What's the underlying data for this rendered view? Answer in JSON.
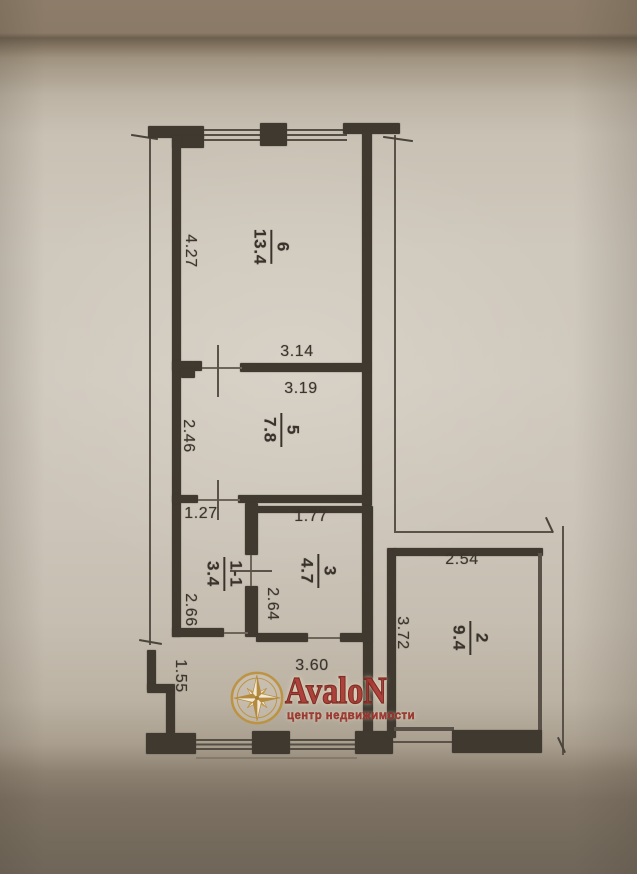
{
  "watermark": {
    "brand": "AvaloN",
    "tagline": "центр недвижимости",
    "brand_color": "#ad3c35",
    "gold_color": "#bd923f",
    "icon": "compass-rose-icon"
  },
  "rooms": [
    {
      "number": "6",
      "area": "13.4"
    },
    {
      "number": "5",
      "area": "7.8"
    },
    {
      "number": "1-1",
      "area": "3.4"
    },
    {
      "number": "3",
      "area": "4.7"
    },
    {
      "number": "2",
      "area": "9.4"
    }
  ],
  "dimensions": {
    "room6_height": "4.27",
    "room6_width": "3.14",
    "room5_width": "3.19",
    "room5_height": "2.46",
    "room11_width": "1.27",
    "room11_height": "2.66",
    "room3_width": "1.77",
    "room3_height": "2.64",
    "room2_width": "2.54",
    "room2_height": "3.72",
    "hall_width": "3.60",
    "hall_height": "1.55"
  },
  "plan": {
    "wall_color": "#3f3930",
    "thin_line_color": "#5a5248",
    "paper_color": "#cfc8bc",
    "text_color": "#39332c"
  }
}
